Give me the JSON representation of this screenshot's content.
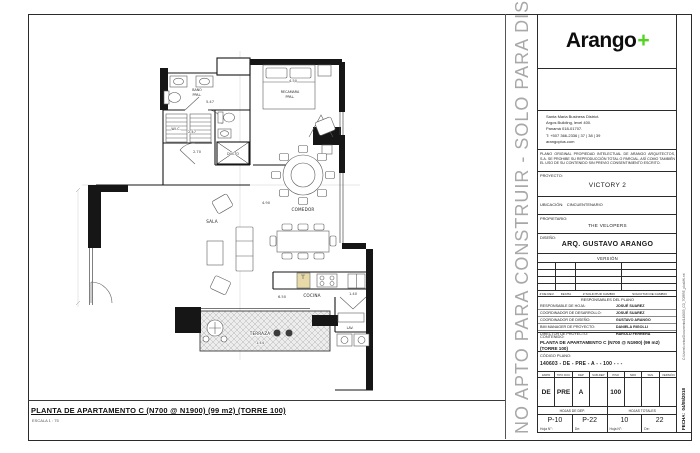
{
  "sheet": {
    "watermark": "NO APTO PARA CONSTRUIR - SOLO PARA DISEÑO",
    "title": "PLANTA DE APARTAMENTO C (N700 @ N1900) (99 m2) (TORRE 100)",
    "scale": "ESCALA 1 : 75"
  },
  "titleblock": {
    "logo_text": "Arango",
    "logo_plus": "+",
    "brand_green": "#4fd41f",
    "address_lines": [
      "Santa Maria Business District.",
      "Argos Building, level 400.",
      "Panamá 018-01707.",
      "T: +507 366-2336 | 37 | 38 | 39",
      "arangoplus.com"
    ],
    "legal": "PLANO ORIGINAL PROPIEDAD INTELECTUAL DE ARANGO ARQUITECTOS, S.A.  SE PROHIBE SU REPRODUCCIÓN  TOTAL O PARCIAL, ASÍ COMO TAMBIÉN EL USO DE SU CONTENIDO SIN PREVIO CONSENTIMIENTO ESCRITO.",
    "proyecto_label": "PROYECTO:",
    "proyecto": "VICTORY 2",
    "ubicacion_label": "UBICACIÓN:",
    "ubicacion": "CINCUENTENARIO",
    "propietario_label": "PROPIETARIO:",
    "propietario": "THE VELOPERS",
    "diseno_label": "DISEÑO:",
    "diseno": "ARQ. GUSTAVO ARANGO",
    "version_label": "VERSIÓN",
    "rev_headers": [
      "# DE REV.",
      "FECHA",
      "# SOLICITUD CAMBIO",
      "SOLICITUD DE CAMBIO"
    ],
    "responsables_title": "RESPONSABLES DEL PLANO",
    "responsables": [
      {
        "label": "RESPONSABLE DE HOJA:",
        "value": "JOSUÉ SUAREZ"
      },
      {
        "label": "COORDINADOR DE DESARROLLO:",
        "value": "JOSUÉ SUAREZ"
      },
      {
        "label": "COORDINADOR DE DISEÑO:",
        "value": "GUSTAVO ARANGO"
      },
      {
        "label": "BIM MANAGER DE PROYECTO:",
        "value": "DANIELA RIGOLLI"
      },
      {
        "label": "DIRECTOR DE PROYECTO:",
        "value": "HAROLD FERRERA"
      }
    ],
    "contenido_label": "CONTENIDO:",
    "contenido_l1": "PLANTA DE APARTAMENTO C (N700 @ N1900) (99 m2)",
    "contenido_l2": "(TORRE 100)",
    "codigo_label": "CÓDIGO PLANO:",
    "codigo": "140603 - DE -  PRE -  A    -        -    100   -        -        -",
    "code_columns": [
      {
        "header": "EMPR",
        "value": "DE"
      },
      {
        "header": "TIPO DOC",
        "value": "PRE"
      },
      {
        "header": "DEP",
        "value": "A"
      },
      {
        "header": "SUB-DEP",
        "value": ""
      },
      {
        "header": "PISO",
        "value": "100"
      },
      {
        "header": "NRO",
        "value": ""
      },
      {
        "header": "SML",
        "value": ""
      },
      {
        "header": "VERSIÓN",
        "value": ""
      }
    ],
    "hojas_dep_label": "HOJAS DE DEP.",
    "hojas_totales_label": "HOJAS TOTALES",
    "hoja_n_label": "Hoja N°:",
    "de_label": "De:",
    "hojas": {
      "dep_n": "P-10",
      "dep_de": "P-22",
      "tot_n": "10",
      "tot_de": "22"
    },
    "fecha_label": "FECHA:",
    "fecha": "04/05/2018",
    "file_path": "C:\\Users\\corina\\Documents\\140603_CD_TORRE_plusMK.rvt"
  },
  "plan": {
    "labels": {
      "recamara_l1": "RECAMARA",
      "recamara_l2": "PPAL.",
      "bano_l1": "BAÑO",
      "bano_l2": "PPAL.",
      "wic": "W.I.C.",
      "ducto": "DUCTO",
      "comedor": "COMEDOR",
      "sala": "SALA",
      "cocina": "COCINA",
      "lav": "LAV.",
      "terraza": "TERRAZA"
    },
    "dimensions": {
      "bano": "5.47",
      "recamara": "4.50",
      "wic_w": "2.47",
      "wic_h": "2.70",
      "comedor": "4.90",
      "cocina": "6.50",
      "terraza": "1.44",
      "lav": "1.40"
    }
  }
}
